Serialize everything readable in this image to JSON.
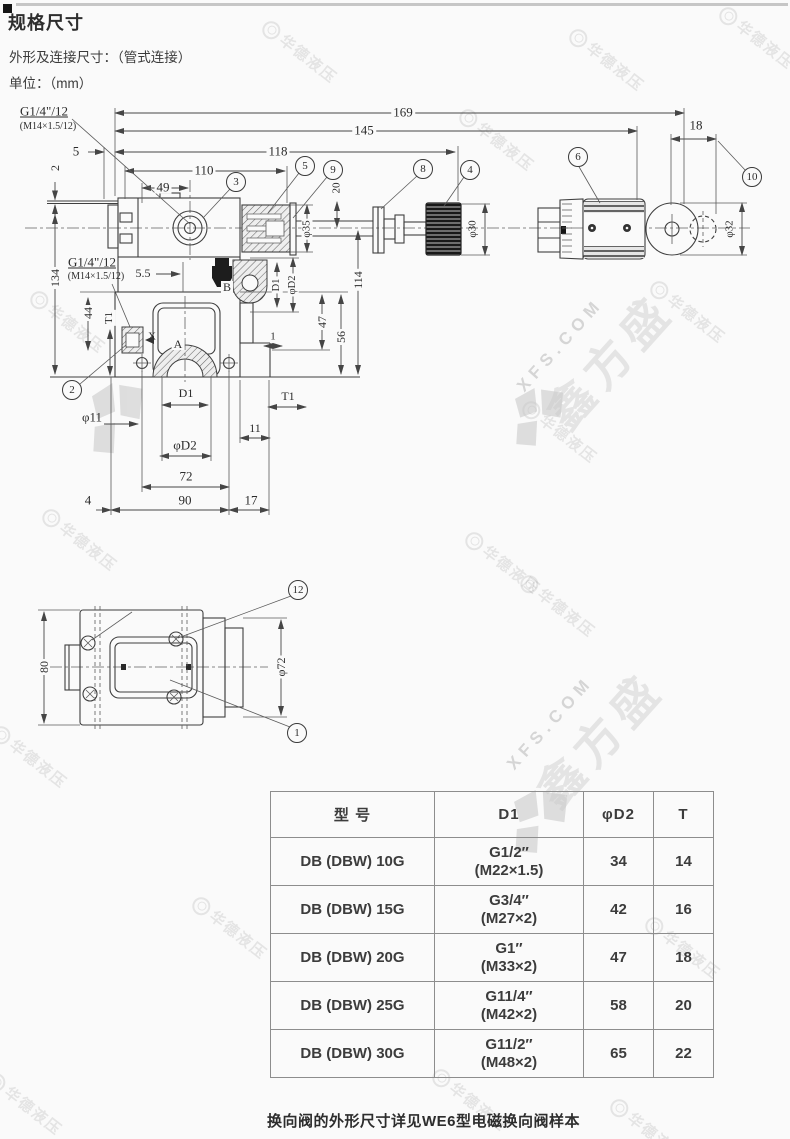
{
  "header": {
    "title": "规格尺寸",
    "subtitle": "外形及连接尺寸：（管式连接）",
    "unit": "单位：（mm）"
  },
  "drawing": {
    "dims": [
      {
        "t": "G1/4\"/12",
        "x": 44,
        "y": 111,
        "fs": 13,
        "u": 1
      },
      {
        "t": "(M14×1.5/12)",
        "x": 48,
        "y": 127,
        "fs": 10
      },
      {
        "t": "169",
        "x": 403,
        "y": 112,
        "fs": 13,
        "bg": 1
      },
      {
        "t": "145",
        "x": 364,
        "y": 130,
        "fs": 13,
        "bg": 1
      },
      {
        "t": "118",
        "x": 278,
        "y": 151,
        "fs": 13,
        "bg": 1
      },
      {
        "t": "110",
        "x": 204,
        "y": 170,
        "fs": 13,
        "bg": 1
      },
      {
        "t": "5",
        "x": 76,
        "y": 151,
        "fs": 13
      },
      {
        "t": "49",
        "x": 163,
        "y": 187,
        "fs": 13,
        "bg": 1
      },
      {
        "t": "2",
        "x": 55,
        "y": 168,
        "r": -90,
        "fs": 12
      },
      {
        "t": "18",
        "x": 696,
        "y": 125,
        "fs": 13
      },
      {
        "t": "20",
        "x": 337,
        "y": 188,
        "r": -90,
        "fs": 11,
        "bg": 1
      },
      {
        "t": "φ35",
        "x": 307,
        "y": 229,
        "r": -90,
        "fs": 11,
        "bg": 1
      },
      {
        "t": "φ30",
        "x": 473,
        "y": 229,
        "r": -90,
        "fs": 11
      },
      {
        "t": "φ32",
        "x": 730,
        "y": 229,
        "r": -90,
        "fs": 11
      },
      {
        "t": "G1/4\"/12",
        "x": 92,
        "y": 262,
        "fs": 13,
        "u": 1
      },
      {
        "t": "(M14×1.5/12)",
        "x": 96,
        "y": 277,
        "fs": 10
      },
      {
        "t": "134",
        "x": 55,
        "y": 278,
        "r": -90,
        "fs": 12,
        "bg": 1
      },
      {
        "t": "5.5",
        "x": 143,
        "y": 273,
        "fs": 12
      },
      {
        "t": "B",
        "x": 227,
        "y": 287,
        "fs": 12,
        "bg": 1
      },
      {
        "t": "D1",
        "x": 277,
        "y": 285,
        "r": -90,
        "fs": 10.5,
        "bg": 1
      },
      {
        "t": "φD2",
        "x": 293,
        "y": 285,
        "r": -90,
        "fs": 10.5,
        "bg": 1
      },
      {
        "t": "114",
        "x": 358,
        "y": 280,
        "r": -90,
        "fs": 12,
        "bg": 1
      },
      {
        "t": "44",
        "x": 88,
        "y": 313,
        "r": -90,
        "fs": 12,
        "bg": 1
      },
      {
        "t": "T1",
        "x": 110,
        "y": 318,
        "r": -90,
        "fs": 10.5,
        "bg": 1
      },
      {
        "t": "X",
        "x": 152,
        "y": 337,
        "fs": 11
      },
      {
        "t": "A",
        "x": 178,
        "y": 344,
        "fs": 12,
        "bg": 1
      },
      {
        "t": "47",
        "x": 322,
        "y": 322,
        "r": -90,
        "fs": 12,
        "bg": 1
      },
      {
        "t": "56",
        "x": 341,
        "y": 337,
        "r": -90,
        "fs": 12,
        "bg": 1
      },
      {
        "t": "1",
        "x": 273,
        "y": 337,
        "fs": 11
      },
      {
        "t": "φ11",
        "x": 92,
        "y": 417,
        "fs": 13
      },
      {
        "t": "D1",
        "x": 186,
        "y": 393,
        "fs": 12
      },
      {
        "t": "T1",
        "x": 288,
        "y": 396,
        "fs": 12
      },
      {
        "t": "11",
        "x": 255,
        "y": 428,
        "fs": 12
      },
      {
        "t": "φD2",
        "x": 185,
        "y": 445,
        "fs": 13
      },
      {
        "t": "72",
        "x": 186,
        "y": 476,
        "fs": 13
      },
      {
        "t": "90",
        "x": 185,
        "y": 500,
        "fs": 13
      },
      {
        "t": "4",
        "x": 88,
        "y": 500,
        "fs": 13
      },
      {
        "t": "17",
        "x": 251,
        "y": 500,
        "fs": 13
      },
      {
        "t": "80",
        "x": 44,
        "y": 667,
        "r": -90,
        "fs": 12,
        "bg": 1
      },
      {
        "t": "φ72",
        "x": 281,
        "y": 667,
        "r": -90,
        "fs": 12,
        "bg": 1
      }
    ],
    "callouts": [
      {
        "t": "3",
        "x": 236,
        "y": 182
      },
      {
        "t": "5",
        "x": 305,
        "y": 166
      },
      {
        "t": "9",
        "x": 333,
        "y": 170
      },
      {
        "t": "8",
        "x": 423,
        "y": 169
      },
      {
        "t": "4",
        "x": 470,
        "y": 170
      },
      {
        "t": "6",
        "x": 578,
        "y": 157
      },
      {
        "t": "10",
        "x": 752,
        "y": 177
      },
      {
        "t": "2",
        "x": 72,
        "y": 390
      },
      {
        "t": "12",
        "x": 298,
        "y": 590
      },
      {
        "t": "1",
        "x": 297,
        "y": 733
      }
    ]
  },
  "table": {
    "headers": [
      "型 号",
      "D1",
      "φD2",
      "T"
    ],
    "rows": [
      {
        "model": "DB (DBW) 10G",
        "d1": "G1/2″",
        "d1m": "(M22×1.5)",
        "d2": "34",
        "T": "14"
      },
      {
        "model": "DB (DBW) 15G",
        "d1": "G3/4″",
        "d1m": "(M27×2)",
        "d2": "42",
        "T": "16"
      },
      {
        "model": "DB (DBW) 20G",
        "d1": "G1″",
        "d1m": "(M33×2)",
        "d2": "47",
        "T": "18"
      },
      {
        "model": "DB (DBW) 25G",
        "d1": "G11/4″",
        "d1m": "(M42×2)",
        "d2": "58",
        "T": "20"
      },
      {
        "model": "DB (DBW) 30G",
        "d1": "G11/2″",
        "d1m": "(M48×2)",
        "d2": "65",
        "T": "22"
      }
    ]
  },
  "footer": {
    "note": "换向阀的外形尺寸详见WE6型电磁换向阀样本"
  },
  "watermarks": {
    "logo_text": "华德液压",
    "xfs_domain": "XFS.COM",
    "xfs_brand": "鑫方盛",
    "circles": [
      {
        "x": 300,
        "y": 52,
        "r": 38
      },
      {
        "x": 607,
        "y": 60,
        "r": 38
      },
      {
        "x": 757,
        "y": 38,
        "r": 38
      },
      {
        "x": 497,
        "y": 140,
        "r": 38
      },
      {
        "x": 68,
        "y": 322,
        "r": 38
      },
      {
        "x": 688,
        "y": 312,
        "r": 38
      },
      {
        "x": 560,
        "y": 432,
        "r": 38
      },
      {
        "x": 80,
        "y": 540,
        "r": 38
      },
      {
        "x": 503,
        "y": 563,
        "r": 38
      },
      {
        "x": 558,
        "y": 606,
        "r": 38
      },
      {
        "x": 30,
        "y": 757,
        "r": 38
      },
      {
        "x": 230,
        "y": 928,
        "r": 38
      },
      {
        "x": 683,
        "y": 948,
        "r": 38
      },
      {
        "x": 470,
        "y": 1100,
        "r": 38
      },
      {
        "x": 25,
        "y": 1104,
        "r": 38
      },
      {
        "x": 648,
        "y": 1130,
        "r": 38
      }
    ],
    "brands": [
      {
        "x": 600,
        "y": 352,
        "r": -48
      },
      {
        "x": 590,
        "y": 730,
        "r": -48
      }
    ]
  }
}
